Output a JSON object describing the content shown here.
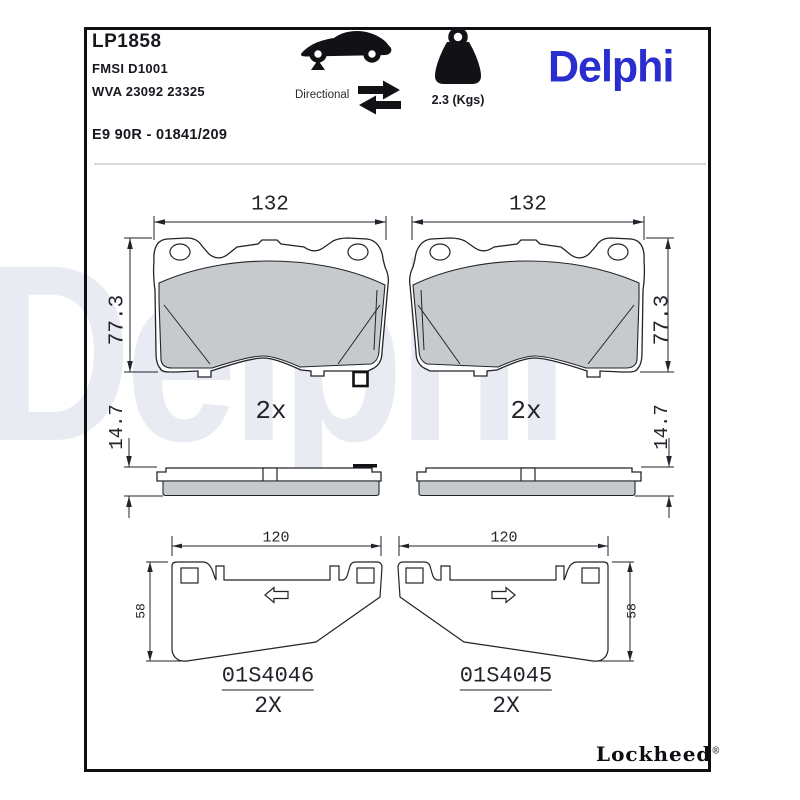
{
  "header": {
    "part_number": "LP1858",
    "fmsi": "FMSI D1001",
    "wva": "WVA 23092 23325",
    "approval": "E9 90R - 01841/209",
    "directional_label": "Directional",
    "weight": "2.3 (Kgs)",
    "brand": "Delphi"
  },
  "watermark": {
    "text": "Delphi"
  },
  "footer": {
    "brand": "Lockheed",
    "reg": "®"
  },
  "drawings": {
    "pad_front_left": {
      "width_dim": "132",
      "height_dim": "77.3",
      "qty": "2x"
    },
    "pad_front_right": {
      "width_dim": "132",
      "height_dim": "77.3",
      "qty": "2x"
    },
    "pad_side_left": {
      "thickness_dim": "14.7"
    },
    "pad_side_right": {
      "thickness_dim": "14.7"
    },
    "shim_left": {
      "width_dim": "120",
      "height_dim": "58",
      "part": "01S4046",
      "qty": "2X"
    },
    "shim_right": {
      "width_dim": "120",
      "height_dim": "58",
      "part": "01S4045",
      "qty": "2X"
    }
  },
  "colors": {
    "brand_blue": "#2B2ECF",
    "line": "#23232b",
    "friction_gray": "#c7cacd",
    "watermark": "#e8ebf2"
  }
}
